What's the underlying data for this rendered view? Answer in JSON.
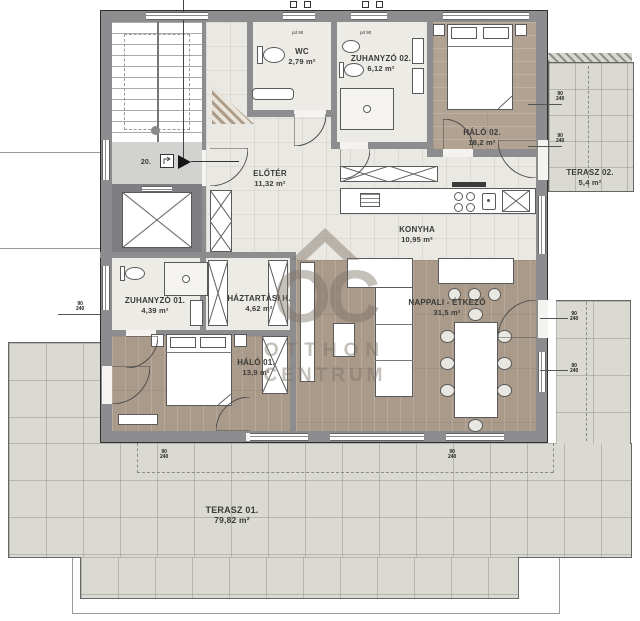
{
  "watermark": {
    "monogram": "OC",
    "line1": "OTTHON",
    "line2": "CENTRUM"
  },
  "landing": {
    "number": "20."
  },
  "rooms": {
    "wc": {
      "name": "WC",
      "area": "2,79 m²"
    },
    "zuhanyzo02": {
      "name": "ZUHANYZÓ 02.",
      "area": "6,12 m²"
    },
    "halo02": {
      "name": "HÁLÓ 02.",
      "area": "18,2 m²"
    },
    "terasz02": {
      "name": "TERASZ 02.",
      "area": "5,4 m²"
    },
    "eloter": {
      "name": "ELŐTÉR",
      "area": "11,32 m²"
    },
    "konyha": {
      "name": "KONYHA",
      "area": "10,95 m²"
    },
    "zuhanyzo01": {
      "name": "ZUHANYZÓ 01.",
      "area": "4,39 m²"
    },
    "haztartasi": {
      "name": "HÁZTARTÁSI H.",
      "area": "4,62 m²"
    },
    "halo01": {
      "name": "HÁLÓ 01.",
      "area": "13,9 m²"
    },
    "nappali": {
      "name": "NAPPALI - ÉTKEZŐ",
      "area": "31,5 m²"
    },
    "terasz01": {
      "name": "TERASZ 01.",
      "area": "79,82 m²"
    }
  },
  "dims": {
    "pd90": "pd 90",
    "width": "90",
    "height": "240"
  },
  "colors": {
    "wall": "#8d8d90",
    "wood": "#a99a89",
    "tile": "#eae8e2",
    "terrace": "#dbdad2",
    "furniture": "#ffffff"
  }
}
